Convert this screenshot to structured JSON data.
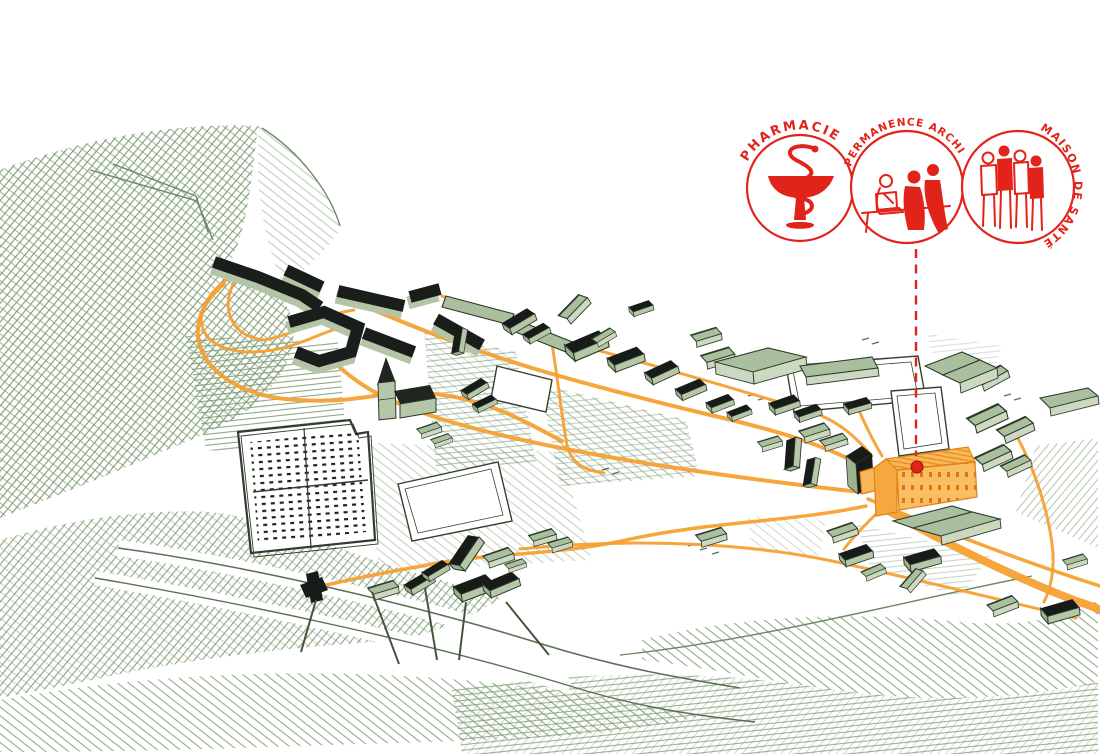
{
  "annotations": {
    "vignettes": [
      {
        "id": "pharmacie",
        "label": "PHARMACIE",
        "icon": "bowl-of-hygieia-icon"
      },
      {
        "id": "permanence-archi",
        "label": "PERMANENCE ARCHI",
        "icon": "people-at-desk-icon"
      },
      {
        "id": "maison-de-sante",
        "label": "MAISON DE SANTÉ",
        "icon": "medical-team-icon"
      }
    ],
    "callout": {
      "style": "dashed-line",
      "target": "highlighted-building"
    }
  },
  "colors": {
    "red_annotation": "#e2231a",
    "orange_route": "#f59f2e",
    "orange_building": "#f6a83f",
    "green_hatch": "#7d9c74",
    "building_dark": "#191e1a",
    "building_wall_light": "#b3c4a7",
    "building_green": "#aabf9d",
    "background": "#ffffff"
  },
  "map_features": {
    "village": "axonometric-village-buildings",
    "church": "church-with-spire",
    "cemetery": "walled-cemetery",
    "routes": "orange-pedestrian-routes",
    "highlighted_building": "maison-de-sante-site"
  }
}
